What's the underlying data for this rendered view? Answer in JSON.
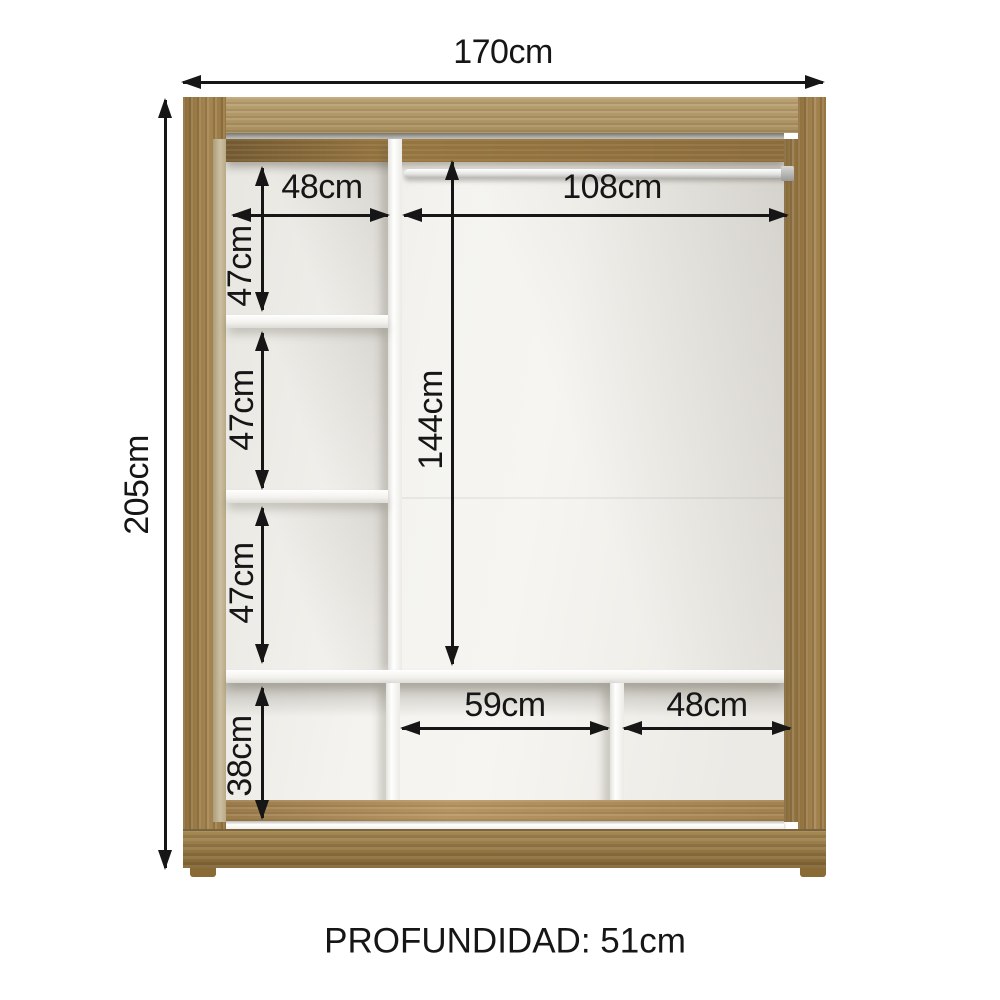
{
  "diagram": {
    "type": "furniture-dimension-diagram",
    "subject": "wardrobe-interior",
    "dims": {
      "total_width": "170cm",
      "total_height": "205cm",
      "upper_left_width": "48cm",
      "rod_width": "108cm",
      "left_cell_1_height": "47cm",
      "left_cell_2_height": "47cm",
      "left_cell_3_height": "47cm",
      "right_section_height": "144cm",
      "bottom_left_height": "38cm",
      "bottom_middle_width": "59cm",
      "bottom_right_width": "48cm"
    },
    "depth_caption": "PROFUNDIDAD: 51cm",
    "colors": {
      "frame_top": "#b39762",
      "frame_side": "#9e7b42",
      "floor": "#b18c55",
      "base": "#9c7a3d",
      "bevel": "#c2b28e",
      "interior": "#f2f1ed",
      "shelf": "#fbfaf7",
      "dimension_line": "#161616",
      "bg": "#ffffff"
    }
  }
}
